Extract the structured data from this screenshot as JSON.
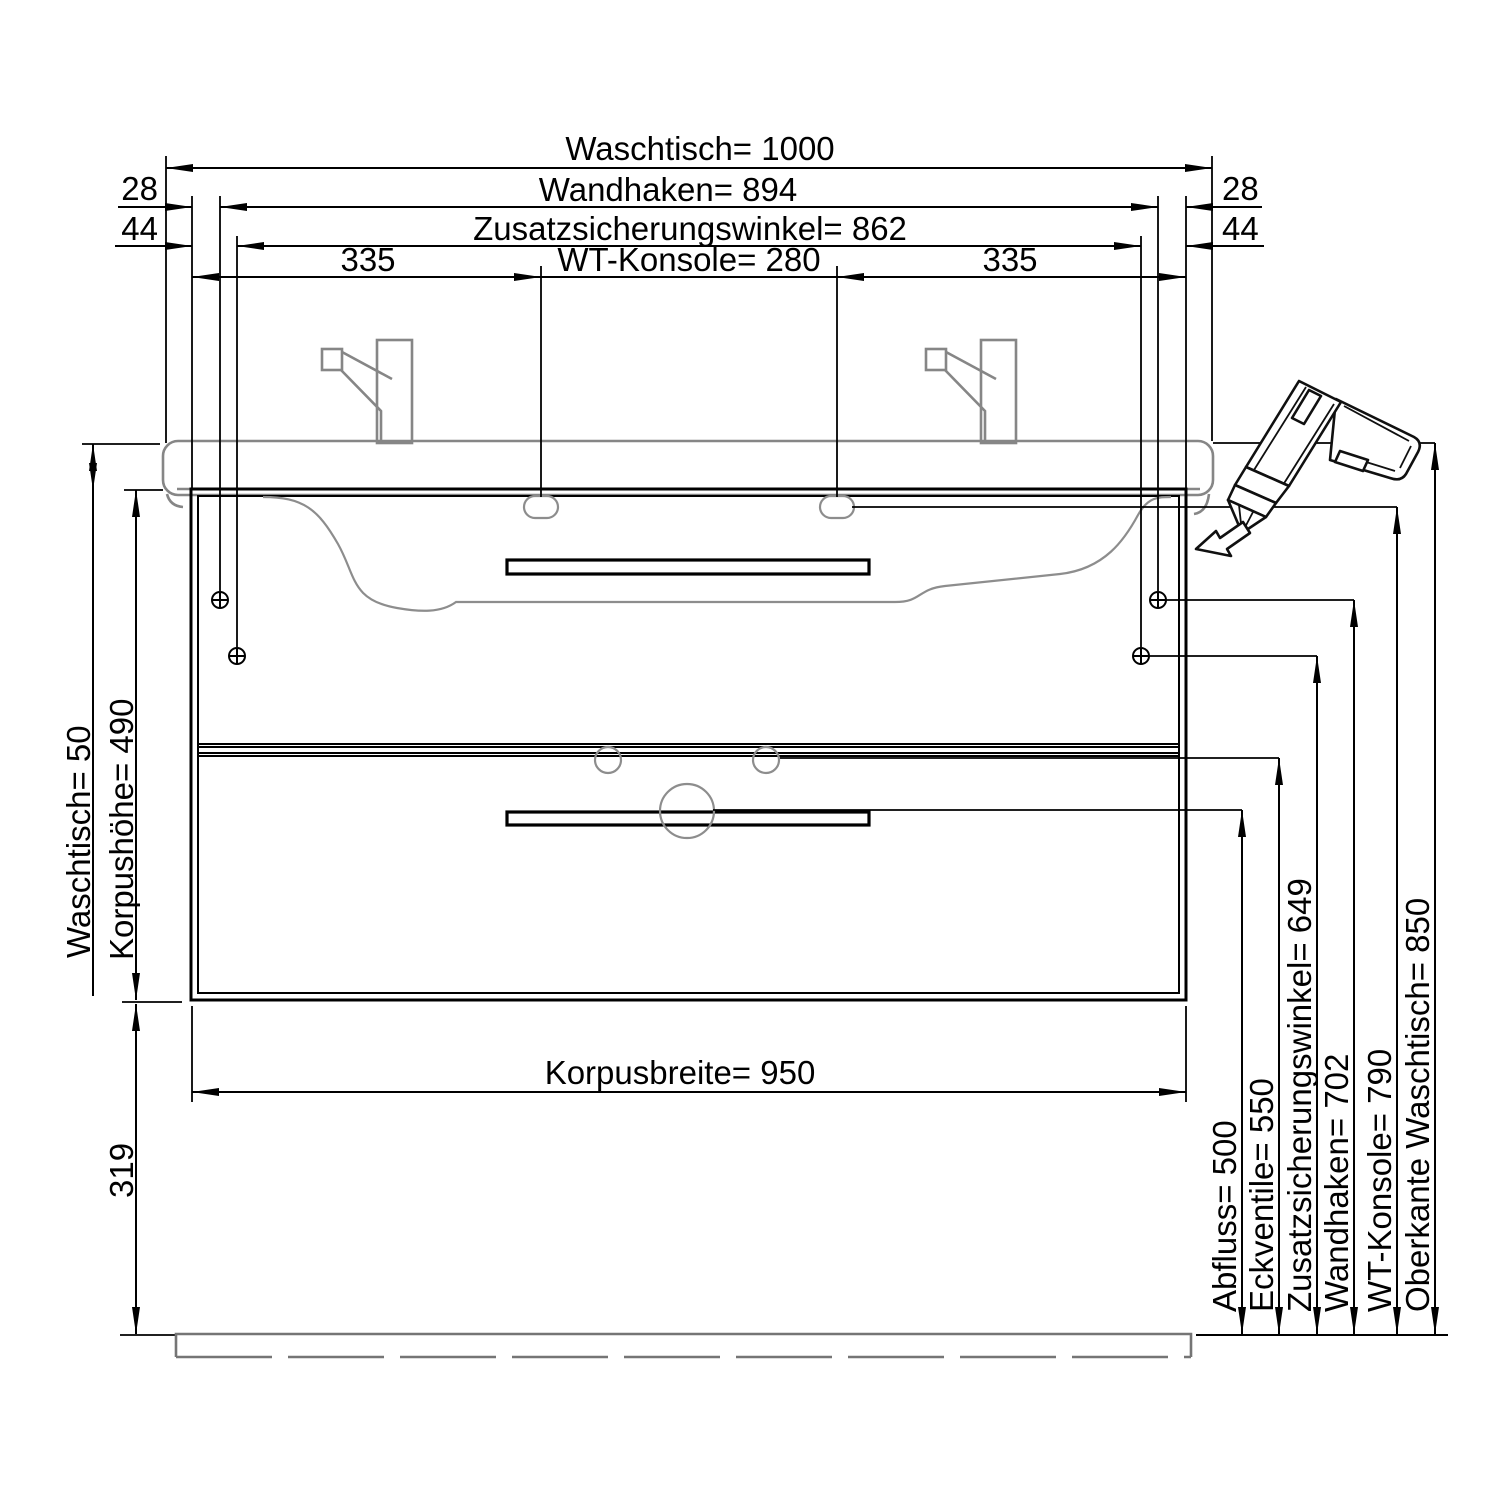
{
  "title": "vanity-unit-installation-dimension-drawing",
  "colors": {
    "line": "#000000",
    "secondary_gray": "#868686",
    "floor_gray": "#757575",
    "background": "#ffffff"
  },
  "icons": {
    "tool": "cordless-screwdriver-icon",
    "insert_arrow": "insertion-direction-arrow-icon",
    "screw": "screw-crosshair-icon"
  },
  "dims_top": {
    "waschtisch_width": "Waschtisch= 1000",
    "wandhaken_width": "Wandhaken= 894",
    "zusatzwinkel_width": "Zusatzsicherungswinkel= 862",
    "konsole_width": "WT-Konsole= 280",
    "seg_335_left": "335",
    "seg_335_right": "335",
    "off_28_left": "28",
    "off_28_right": "28",
    "off_44_left": "44",
    "off_44_right": "44"
  },
  "dims_left": {
    "waschtisch_height": "Waschtisch= 50",
    "korpushoehe": "Korpushöhe= 490",
    "sockel_height": "319"
  },
  "dims_bottom": {
    "korpusbreite": "Korpusbreite= 950"
  },
  "dims_right": {
    "abfluss": "Abfluss= 500",
    "eckventile": "Eckventile= 550",
    "zusatzwinkel_height": "Zusatzsicherungswinkel= 649",
    "wandhaken_height": "Wandhaken= 702",
    "konsole_height": "WT-Konsole= 790",
    "oberkante": "Oberkante Waschtisch= 850"
  }
}
